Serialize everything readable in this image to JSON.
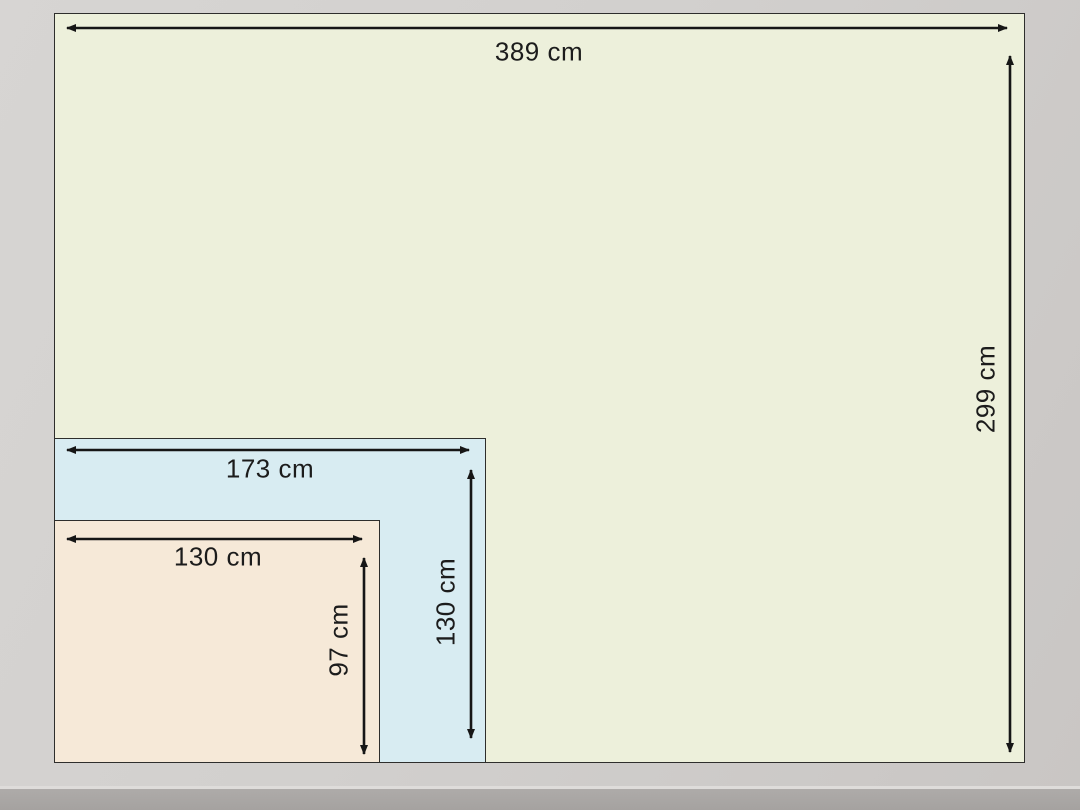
{
  "diagram": {
    "unit": "cm",
    "rectangles": [
      {
        "id": "large",
        "width_cm": 389,
        "height_cm": 299,
        "width_label": "389 cm",
        "height_label": "299 cm",
        "fill": "#edf0db"
      },
      {
        "id": "medium",
        "width_cm": 173,
        "height_cm": 130,
        "width_label": "173 cm",
        "height_label": "130 cm",
        "fill": "#d8ecf2"
      },
      {
        "id": "small",
        "width_cm": 130,
        "height_cm": 97,
        "width_label": "130 cm",
        "height_label": "97 cm",
        "fill": "#f6e9d8"
      }
    ],
    "colors": {
      "arrow": "#161616",
      "label_text": "#1c1c1c",
      "rect_border": "#2e2e2c",
      "background": "#d2d0ce",
      "bottom_band": "#a8a5a3"
    }
  }
}
